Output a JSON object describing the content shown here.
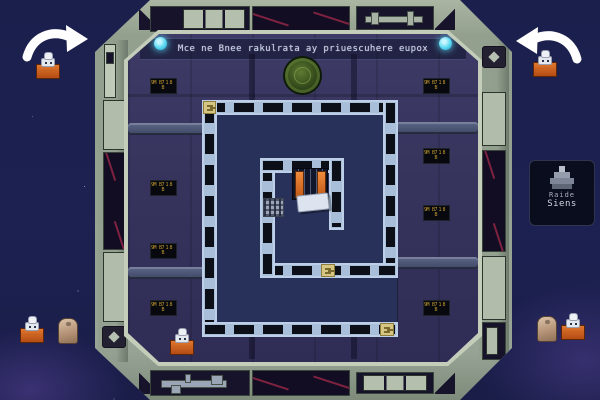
{
  "banner": {
    "text": "Mce ne Bnee rakulrata ay priuescuhere eupox"
  },
  "tooltip": {
    "title": "Raide",
    "subtitle": "Siens"
  },
  "wall_sign": {
    "line1": "M 718 B",
    "line2": "9 B"
  },
  "icons": {
    "arrow_left": "curved-white-arrow-pointing-left",
    "arrow_right": "curved-white-arrow-pointing-right",
    "emblem": "green-circular-station-seal",
    "cyan_light": "glowing-cyan-lamp",
    "ship": "gray-pixel-ship",
    "diamond": "diamond-hazard-badge"
  },
  "colors": {
    "space": "#1d2152",
    "frame": "#97a394",
    "interior_wall": "#37355e",
    "maze_floor": "#28315a",
    "maze_wall": "#a9bed9",
    "door_panel": "#0c0f18",
    "accent_cyan": "#58d8f2",
    "accent_orange": "#c0561c",
    "sign_text": "#c49a2e",
    "emblem_green": "#32491b",
    "tile_yellow": "#d6c683",
    "window_red": "#7e2240"
  }
}
